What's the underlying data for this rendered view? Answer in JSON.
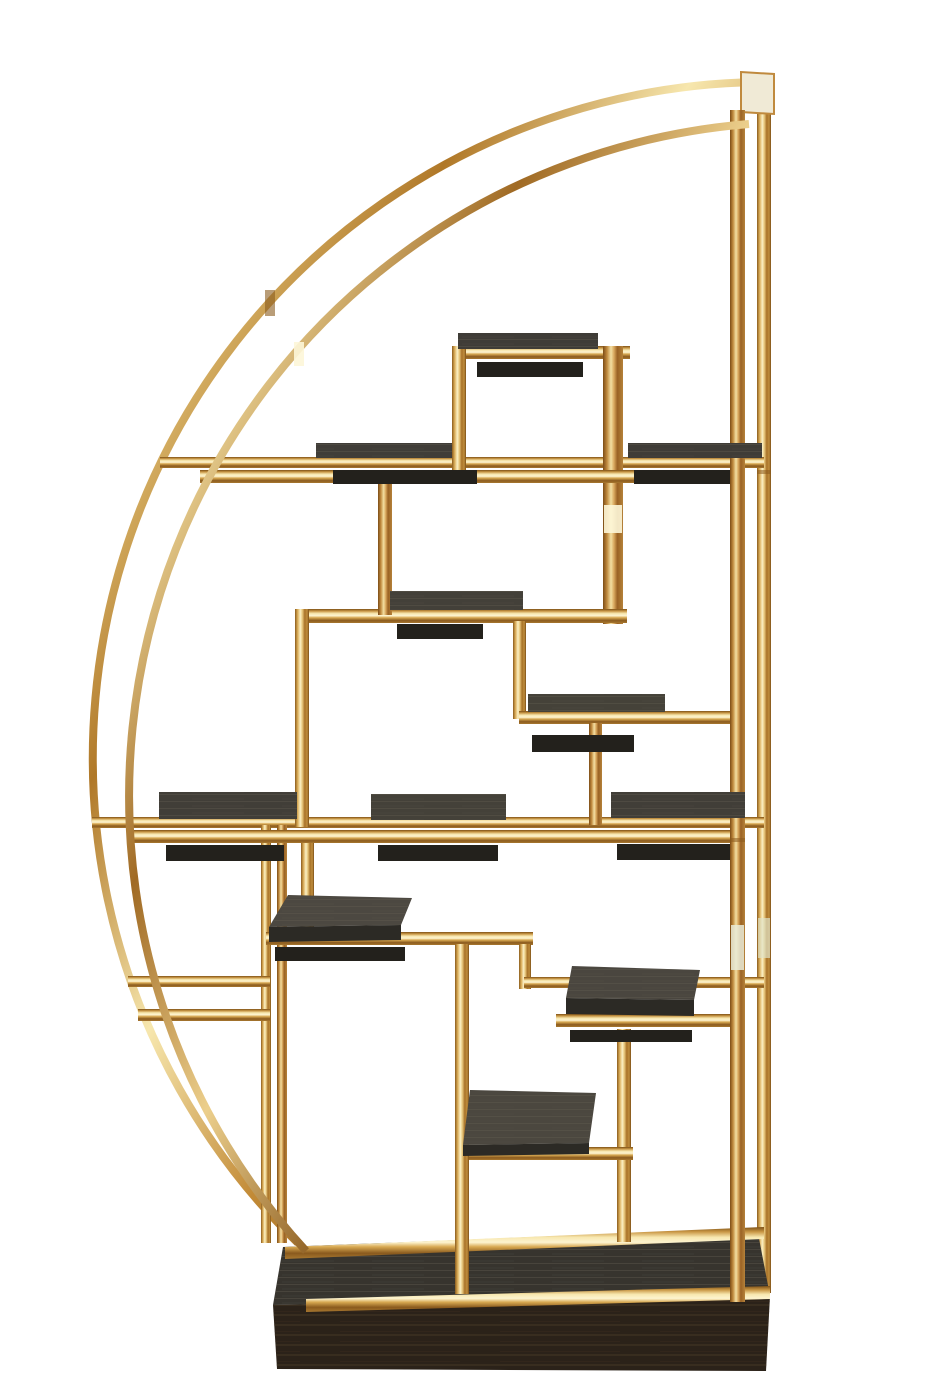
{
  "meta": {
    "subject": "half-moon brass etagere display shelf with dark wood shelves and plinth base",
    "background": "#ffffff"
  },
  "palette": {
    "gold_highlight": "#fdf4d0",
    "gold_light": "#e9cd84",
    "gold_mid": "#c99745",
    "gold_deep": "#8a5a1e",
    "shelf_wood": "#434039",
    "shelf_edge": "#2c2a25",
    "shelf_shadow": "#23211c",
    "base_top": "#37342e",
    "base_front": "#2b2219"
  },
  "scene": {
    "canvas": {
      "width": 933,
      "height": 1400,
      "background": "#ffffff"
    },
    "elements": [
      {
        "kind": "arc",
        "name": "back-arc",
        "d": "M 757 82 A 676 676 0 0 0 298 1243",
        "w": 8,
        "grad": "goldArc"
      },
      {
        "kind": "bar",
        "name": "back-right-post",
        "x": 757,
        "y": 78,
        "w": 14,
        "h": 1215,
        "grad": "goldV"
      },
      {
        "kind": "poly",
        "name": "apex-cap",
        "points": "741,72 774,74 774,114 741,112",
        "fill": "#f0ead6",
        "stroke": "#c08a3e"
      },
      {
        "kind": "bar",
        "name": "rail-a-back",
        "x": 160,
        "y": 457,
        "w": 604,
        "h": 11,
        "grad": "goldH"
      },
      {
        "kind": "bar",
        "name": "rail-b-back",
        "x": 92,
        "y": 817,
        "w": 672,
        "h": 11,
        "grad": "goldH"
      },
      {
        "kind": "poly",
        "name": "base-top",
        "points": "283,1247 757,1228 770,1296 273,1305",
        "fill": "#37342e",
        "grain": "grainA"
      },
      {
        "kind": "poly",
        "name": "base-back-rail",
        "points": "285,1247 764,1227 764,1239 285,1259",
        "fill": "url(#goldH)"
      },
      {
        "kind": "bar",
        "name": "left-pair-post-a",
        "x": 261,
        "y": 825,
        "w": 10,
        "h": 418,
        "grad": "goldV"
      },
      {
        "kind": "bar",
        "name": "left-pair-post-b",
        "x": 277,
        "y": 825,
        "w": 10,
        "h": 418,
        "grad": "goldV2"
      },
      {
        "kind": "bar",
        "name": "lower-right-vert",
        "x": 617,
        "y": 1029,
        "w": 14,
        "h": 213,
        "grad": "goldV"
      },
      {
        "kind": "bar",
        "name": "top-frame-rail",
        "x": 452,
        "y": 346,
        "w": 178,
        "h": 13,
        "grad": "goldH"
      },
      {
        "kind": "bar",
        "name": "top-frame-left-vert",
        "x": 452,
        "y": 346,
        "w": 14,
        "h": 131,
        "grad": "goldV"
      },
      {
        "kind": "bar",
        "name": "center-vert",
        "x": 603,
        "y": 346,
        "w": 20,
        "h": 278,
        "grad": "goldV2"
      },
      {
        "kind": "bar",
        "name": "midbox-rail",
        "x": 295,
        "y": 609,
        "w": 332,
        "h": 14,
        "grad": "goldH"
      },
      {
        "kind": "bar",
        "name": "midbox-left-vert",
        "x": 295,
        "y": 609,
        "w": 14,
        "h": 218,
        "grad": "goldV"
      },
      {
        "kind": "bar",
        "name": "rail-a-drop-vert",
        "x": 378,
        "y": 478,
        "w": 14,
        "h": 137,
        "grad": "goldV2"
      },
      {
        "kind": "bar",
        "name": "step-vert",
        "x": 513,
        "y": 621,
        "w": 13,
        "h": 98,
        "grad": "goldV"
      },
      {
        "kind": "bar",
        "name": "step-shelf-rail",
        "x": 519,
        "y": 711,
        "w": 226,
        "h": 13,
        "grad": "goldH"
      },
      {
        "kind": "bar",
        "name": "step-down-vert",
        "x": 589,
        "y": 723,
        "w": 13,
        "h": 102,
        "grad": "goldV2"
      },
      {
        "kind": "bar",
        "name": "rail-b-drop-vert",
        "x": 301,
        "y": 834,
        "w": 13,
        "h": 104,
        "grad": "goldV"
      },
      {
        "kind": "bar",
        "name": "midshelf-rail",
        "x": 266,
        "y": 932,
        "w": 267,
        "h": 13,
        "grad": "goldH"
      },
      {
        "kind": "bar",
        "name": "midshelf-corner-vert",
        "x": 519,
        "y": 944,
        "w": 12,
        "h": 45,
        "grad": "goldV"
      },
      {
        "kind": "bar",
        "name": "rightbox-back-rail",
        "x": 524,
        "y": 977,
        "w": 240,
        "h": 11,
        "grad": "goldH"
      },
      {
        "kind": "bar",
        "name": "leftbox-top-rail",
        "x": 128,
        "y": 976,
        "w": 142,
        "h": 11,
        "grad": "goldH"
      },
      {
        "kind": "bar",
        "name": "leftbox-bottom-rail",
        "x": 138,
        "y": 1009,
        "w": 132,
        "h": 12,
        "grad": "goldH"
      },
      {
        "kind": "bar",
        "name": "lowshelf-rail",
        "x": 457,
        "y": 1147,
        "w": 176,
        "h": 13,
        "grad": "goldH"
      },
      {
        "kind": "bar",
        "name": "rail-a-front",
        "x": 200,
        "y": 470,
        "w": 537,
        "h": 13,
        "grad": "goldH"
      },
      {
        "kind": "bar",
        "name": "rail-b-front",
        "x": 130,
        "y": 830,
        "w": 607,
        "h": 13,
        "grad": "goldH"
      },
      {
        "kind": "bar",
        "name": "rightbox-front-rail",
        "x": 556,
        "y": 1014,
        "w": 181,
        "h": 13,
        "grad": "goldH"
      },
      {
        "kind": "rect",
        "name": "shelf-shadow-top",
        "x": 477,
        "y": 362,
        "w": 106,
        "h": 15,
        "fill": "#23211c"
      },
      {
        "kind": "rect",
        "name": "shelf-shadow-a1",
        "x": 333,
        "y": 470,
        "w": 144,
        "h": 14,
        "fill": "#23211c"
      },
      {
        "kind": "rect",
        "name": "shelf-shadow-a2",
        "x": 634,
        "y": 470,
        "w": 96,
        "h": 14,
        "fill": "#23211c"
      },
      {
        "kind": "rect",
        "name": "shelf-shadow-mid",
        "x": 397,
        "y": 624,
        "w": 86,
        "h": 15,
        "fill": "#23211c"
      },
      {
        "kind": "rect",
        "name": "shelf-shadow-step",
        "x": 532,
        "y": 735,
        "w": 102,
        "h": 17,
        "fill": "#23211c"
      },
      {
        "kind": "rect",
        "name": "shelf-shadow-b1",
        "x": 166,
        "y": 845,
        "w": 118,
        "h": 16,
        "fill": "#23211c"
      },
      {
        "kind": "rect",
        "name": "shelf-shadow-b2",
        "x": 378,
        "y": 845,
        "w": 120,
        "h": 16,
        "fill": "#23211c"
      },
      {
        "kind": "rect",
        "name": "shelf-shadow-b3",
        "x": 617,
        "y": 844,
        "w": 118,
        "h": 16,
        "fill": "#23211c"
      },
      {
        "kind": "rect",
        "name": "shelf-shadow-t1",
        "x": 275,
        "y": 947,
        "w": 130,
        "h": 14,
        "fill": "#23211c"
      },
      {
        "kind": "rect",
        "name": "shelf-shadow-t2",
        "x": 570,
        "y": 1030,
        "w": 122,
        "h": 12,
        "fill": "#23211c"
      },
      {
        "kind": "poly",
        "name": "base-front-face",
        "points": "273,1305 770,1296 766,1371 277,1369",
        "fill": "#2b2219",
        "grain": "grainB"
      },
      {
        "kind": "poly",
        "name": "base-front-rail",
        "points": "306,1299 770,1286 770,1299 306,1312",
        "fill": "url(#goldH)"
      },
      {
        "kind": "bar",
        "name": "long-mid-vert",
        "x": 455,
        "y": 944,
        "w": 14,
        "h": 350,
        "grad": "goldV"
      },
      {
        "kind": "bar",
        "name": "front-right-post",
        "x": 730,
        "y": 110,
        "w": 15,
        "h": 1192,
        "grad": "goldV2"
      },
      {
        "kind": "rect",
        "name": "shelf-top-frame",
        "x": 458,
        "y": 333,
        "w": 140,
        "h": 16,
        "fill": "#3f3c37",
        "grain": "grainA"
      },
      {
        "kind": "rect",
        "name": "shelf-a1",
        "x": 316,
        "y": 443,
        "w": 136,
        "h": 15,
        "fill": "#403d38",
        "grain": "grainA"
      },
      {
        "kind": "rect",
        "name": "shelf-a2",
        "x": 628,
        "y": 443,
        "w": 134,
        "h": 15,
        "fill": "#3f3c37",
        "grain": "grainA"
      },
      {
        "kind": "rect",
        "name": "shelf-mid",
        "x": 390,
        "y": 591,
        "w": 133,
        "h": 19,
        "fill": "#434039",
        "grain": "grainA"
      },
      {
        "kind": "rect",
        "name": "shelf-step",
        "x": 528,
        "y": 694,
        "w": 137,
        "h": 18,
        "fill": "#454239",
        "grain": "grainA"
      },
      {
        "kind": "rect",
        "name": "shelf-b1",
        "x": 159,
        "y": 792,
        "w": 138,
        "h": 27,
        "fill": "#413e38",
        "grain": "grainA"
      },
      {
        "kind": "rect",
        "name": "shelf-b2",
        "x": 371,
        "y": 794,
        "w": 135,
        "h": 26,
        "fill": "#444139",
        "grain": "grainA"
      },
      {
        "kind": "rect",
        "name": "shelf-b3",
        "x": 611,
        "y": 792,
        "w": 134,
        "h": 26,
        "fill": "#413e38",
        "grain": "grainA"
      },
      {
        "kind": "poly",
        "name": "shelf-t1-top",
        "points": "288,895 412,898 401,925 269,927",
        "fill": "#4c4841",
        "grain": "grainA"
      },
      {
        "kind": "poly",
        "name": "shelf-t1-edge",
        "points": "269,927 401,925 401,940 269,942",
        "fill": "#2c2a25"
      },
      {
        "kind": "poly",
        "name": "shelf-t2-top",
        "points": "572,966 700,970 694,1000 566,998",
        "fill": "#4a463f",
        "grain": "grainA"
      },
      {
        "kind": "poly",
        "name": "shelf-t2-edge",
        "points": "566,998 694,1000 694,1016 566,1014",
        "fill": "#2c2a25"
      },
      {
        "kind": "poly",
        "name": "shelf-t3-top",
        "points": "470,1090 596,1093 589,1143 463,1145",
        "fill": "#4b473f",
        "grain": "grainA"
      },
      {
        "kind": "poly",
        "name": "shelf-t3-edge",
        "points": "463,1145 589,1143 589,1154 463,1156",
        "fill": "#2c2a25"
      },
      {
        "kind": "arc",
        "name": "front-arc",
        "d": "M 749 124 A 674 674 0 0 0 306 1251",
        "w": 8,
        "grad": "goldArc2"
      },
      {
        "kind": "rect",
        "name": "glint-front-post",
        "x": 731,
        "y": 925,
        "w": 13,
        "h": 45,
        "fill": "#e9ebd8",
        "opacity": 0.85
      },
      {
        "kind": "rect",
        "name": "glint-back-post",
        "x": 758,
        "y": 918,
        "w": 12,
        "h": 40,
        "fill": "#dfe3c8",
        "opacity": 0.7
      },
      {
        "kind": "rect",
        "name": "glint-center-vert",
        "x": 604,
        "y": 505,
        "w": 18,
        "h": 28,
        "fill": "#fdf6d8",
        "opacity": 0.9
      },
      {
        "kind": "rect",
        "name": "glint-front-arc",
        "x": 294,
        "y": 342,
        "w": 10,
        "h": 24,
        "fill": "#fdf6d8",
        "opacity": 0.9
      },
      {
        "kind": "rect",
        "name": "shade-back-arc",
        "x": 265,
        "y": 290,
        "w": 10,
        "h": 26,
        "fill": "#8a5c1e",
        "opacity": 0.6
      },
      {
        "kind": "rect",
        "name": "seam-back-post",
        "x": 757,
        "y": 470,
        "w": 14,
        "h": 4,
        "fill": "#8a5a1e",
        "opacity": 0.55
      },
      {
        "kind": "rect",
        "name": "seam-front-post",
        "x": 730,
        "y": 838,
        "w": 15,
        "h": 4,
        "fill": "#8a5a1e",
        "opacity": 0.55
      }
    ]
  }
}
